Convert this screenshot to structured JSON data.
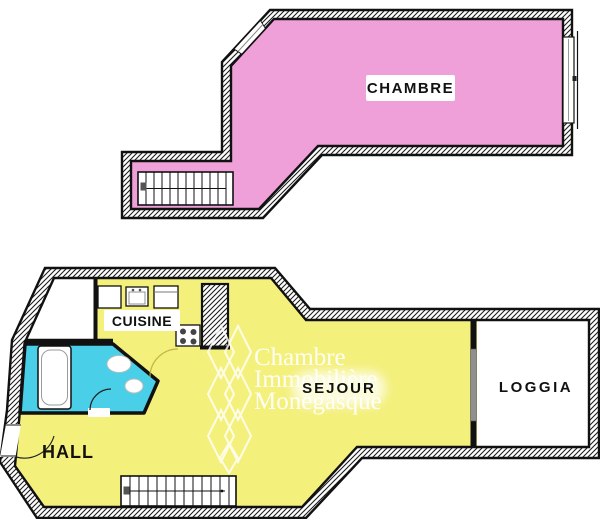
{
  "colors": {
    "chambre_pink": "#efa0d9",
    "living_yellow": "#f4f07c",
    "bath_cyan": "#49cfe8",
    "loggia_white": "#ffffff",
    "wall_black": "#111111",
    "watermark_white": "#ffffff"
  },
  "rooms": {
    "chambre": {
      "label": "CHAMBRE"
    },
    "cuisine": {
      "label": "CUISINE"
    },
    "sejour": {
      "label": "SEJOUR"
    },
    "loggia": {
      "label": "LOGGIA"
    },
    "hall": {
      "label": "HALL"
    }
  },
  "watermark": {
    "line1": "Chambre",
    "line2": "Immobilière",
    "line3": "Monégasque"
  }
}
